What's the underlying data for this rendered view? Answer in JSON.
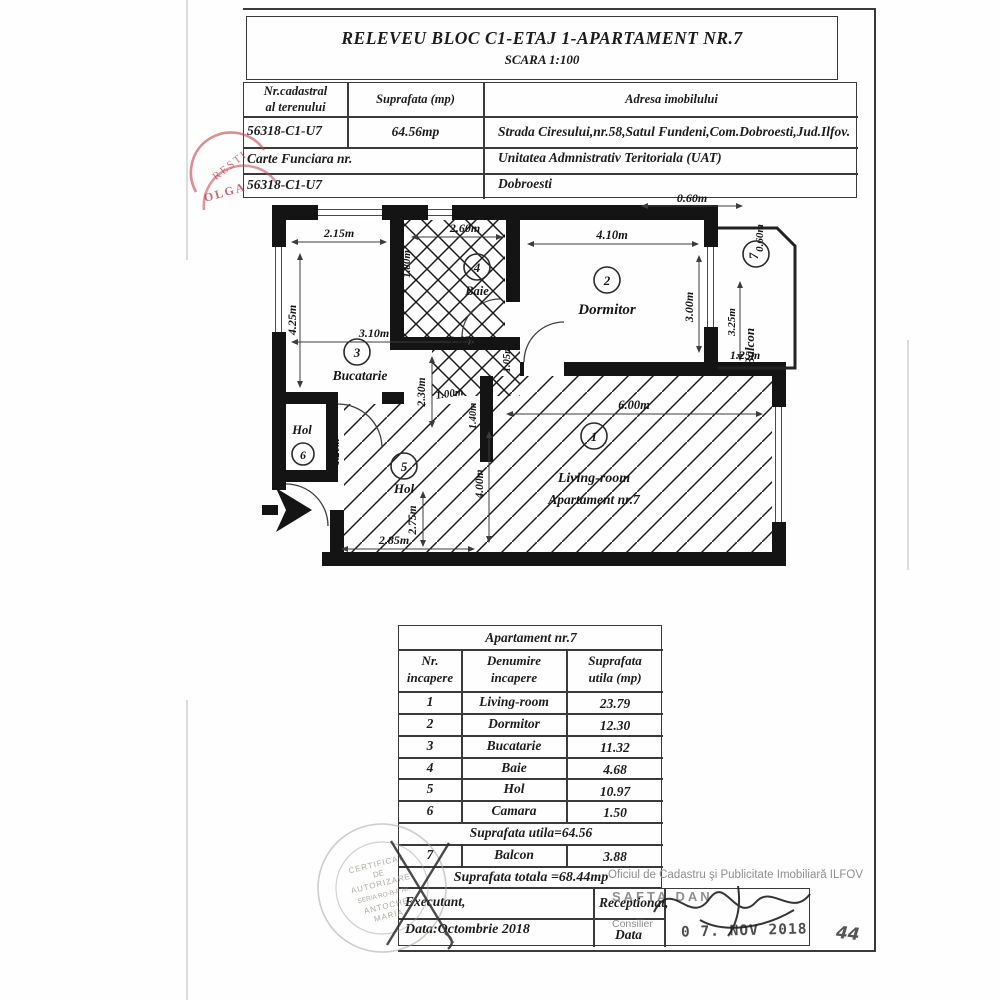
{
  "document": {
    "title": "RELEVEU  BLOC  C1-ETAJ 1-APARTAMENT NR.7",
    "scale": "SCARA 1:100"
  },
  "cadastral_table": {
    "col1_header_line1": "Nr.cadastral",
    "col1_header_line2": "al terenului",
    "col2_header": "Suprafata (mp)",
    "col3_header": "Adresa imobilului",
    "cadastral_number": "56318-C1-U7",
    "surface": "64.56mp",
    "address": "Strada Ciresului,nr.58,Satul Fundeni,Com.Dobroesti,Jud.Ilfov.",
    "carte_funciara_label": "Carte Funciara nr.",
    "uat_label": "Unitatea Admnistrativ Teritoriala (UAT)",
    "carte_funciara_number": "56318-C1-U7",
    "uat_name": "Dobroesti"
  },
  "floor_plan": {
    "rooms": {
      "living": {
        "number": "1",
        "name": "Living-room",
        "subtitle": "Apartament nr.7"
      },
      "dormitor": {
        "number": "2",
        "name": "Dormitor"
      },
      "bucatarie": {
        "number": "3",
        "name": "Bucatarie"
      },
      "baie": {
        "number": "4",
        "name": "Baie"
      },
      "hol": {
        "number": "5",
        "name": "Hol"
      },
      "camara": {
        "number": "6",
        "name": "Hol"
      },
      "balcon": {
        "number": "7",
        "name": "Balcon"
      }
    },
    "dimensions": {
      "bucatarie_width": "2.15m",
      "bucatarie_height": "4.25m",
      "bucatarie_total_width": "3.10m",
      "bucatarie_lower_height": "2.30m",
      "baie_width": "2.60m",
      "baie_height": "1.80m",
      "corridor_width": "1.65m",
      "corridor_door": "1.05m",
      "hol_upper_width": "1.00m",
      "hol_door": "1.40m",
      "dormitor_width": "4.10m",
      "dormitor_height": "3.00m",
      "balcon_depth_top": "0.60m",
      "balcon_depth_side": "0.60m",
      "balcon_height": "3.25m",
      "balcon_bottom_width": "1.25m",
      "living_width": "6.00m",
      "living_height": "4.00m",
      "camara_width": "1.20m",
      "hol_height": "2.75m",
      "hol_width": "2.85m"
    }
  },
  "apartment_table": {
    "title": "Apartament nr.7",
    "header": {
      "col1_line1": "Nr.",
      "col1_line2": "incapere",
      "col2_line1": "Denumire",
      "col2_line2": "incapere",
      "col3_line1": "Suprafata",
      "col3_line2": "utila (mp)"
    },
    "rows": [
      {
        "nr": "1",
        "name": "Living-room",
        "area": "23.79"
      },
      {
        "nr": "2",
        "name": "Dormitor",
        "area": "12.30"
      },
      {
        "nr": "3",
        "name": "Bucatarie",
        "area": "11.32"
      },
      {
        "nr": "4",
        "name": "Baie",
        "area": "4.68"
      },
      {
        "nr": "5",
        "name": "Hol",
        "area": "10.97"
      },
      {
        "nr": "6",
        "name": "Camara",
        "area": "1.50"
      }
    ],
    "useful_area_total": "Suprafata utila=64.56",
    "balcony_row": {
      "nr": "7",
      "name": "Balcon",
      "area": "3.88"
    },
    "total_area": "Suprafata totala =68.44mp"
  },
  "footer": {
    "ocpi_text": "Oficiul de Cadastru şi Publicitate Imobiliară ILFOV",
    "executant_label": "Executant,",
    "receptionat_label": "Receptionat,",
    "receiver_name": "SAFTA DAN",
    "consilier_label": "Consilier",
    "data_left": "Data:Octombrie 2018",
    "data_right_label": "Data",
    "date_stamp": "0 7. NOV 2018",
    "page_number": "44"
  },
  "stamps": {
    "red_stamp": {
      "arc_text": "RESTI",
      "name_text": "OLGA"
    },
    "round_stamp": {
      "line1": "CERTIFICAT",
      "line2": "DE",
      "line3": "AUTORIZARE",
      "line4": "SERIA RO-B-F Nr.",
      "line5": "ANTOCHE",
      "line6": "MARIA"
    }
  }
}
